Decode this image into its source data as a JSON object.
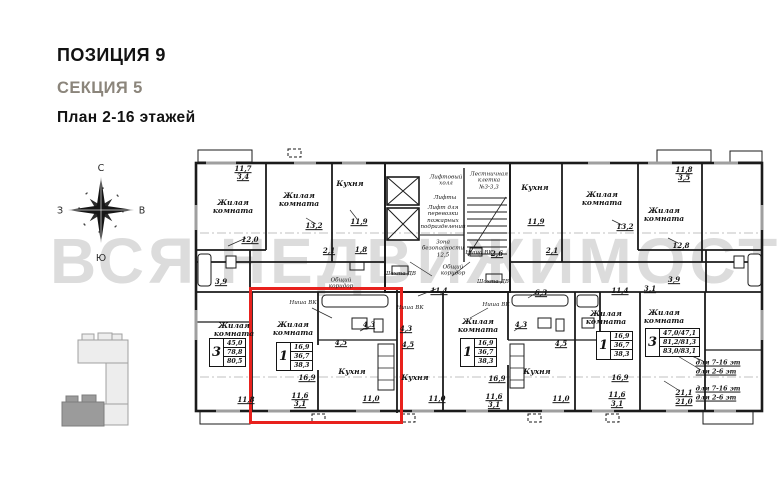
{
  "header": {
    "position": "ПОЗИЦИЯ 9",
    "section": "СЕКЦИЯ 5",
    "plan": "План 2-16 этажей"
  },
  "watermark": {
    "text": "ВСЯ НЕДВИЖИМОСТЬ"
  },
  "compass": {
    "north": "С",
    "south": "Ю",
    "west": "З",
    "east": "В"
  },
  "colors": {
    "accent_red": "#e8211d",
    "section_gray": "#8b857b",
    "watermark_gray": "#dcdcdc"
  },
  "plan": {
    "highlight": {
      "x": 249,
      "y": 287,
      "w": 148,
      "h": 131
    },
    "tables": [
      {
        "num": "3",
        "rows": [
          "45,0",
          "78,8",
          "80,5"
        ],
        "x": 209,
        "y": 338
      },
      {
        "num": "1",
        "rows": [
          "16,9",
          "36,7",
          "38,3"
        ],
        "x": 276,
        "y": 342
      },
      {
        "num": "1",
        "rows": [
          "16,9",
          "36,7",
          "38,3"
        ],
        "x": 460,
        "y": 338
      },
      {
        "num": "1",
        "rows": [
          "16,9",
          "36,7",
          "38,3"
        ],
        "x": 596,
        "y": 331
      },
      {
        "num": "3",
        "rows": [
          "47,0/47,1",
          "81,2/81,3",
          "83,0/83,1"
        ],
        "x": 645,
        "y": 328
      }
    ],
    "labels": [
      {
        "text": "11,7",
        "x": 243,
        "y": 169,
        "cls": "num"
      },
      {
        "text": "3,4",
        "x": 243,
        "y": 177,
        "cls": "num"
      },
      {
        "text": "Жилая\nкомната",
        "x": 233,
        "y": 207,
        "cls": "room"
      },
      {
        "text": "12,0",
        "x": 250,
        "y": 240,
        "cls": "num"
      },
      {
        "text": "Жилая\nкомната",
        "x": 299,
        "y": 200,
        "cls": "room"
      },
      {
        "text": "13,2",
        "x": 314,
        "y": 226,
        "cls": "num"
      },
      {
        "text": "Кухня",
        "x": 350,
        "y": 184,
        "cls": "room"
      },
      {
        "text": "11,9",
        "x": 359,
        "y": 222,
        "cls": "num"
      },
      {
        "text": "Лифтовый\nхолл",
        "x": 446,
        "y": 181,
        "cls": "tiny"
      },
      {
        "text": "Лифты",
        "x": 445,
        "y": 198,
        "cls": "tiny"
      },
      {
        "text": "Лифт для\nперевозки\nпожарных\nподразделений",
        "x": 443,
        "y": 218,
        "cls": "tiny"
      },
      {
        "text": "Лестничная\nклетка\n№3-3,3",
        "x": 489,
        "y": 181,
        "cls": "tiny"
      },
      {
        "text": "Зона\nбезопасности\n12,5",
        "x": 443,
        "y": 249,
        "cls": "tiny"
      },
      {
        "text": "Кухня",
        "x": 535,
        "y": 188,
        "cls": "room"
      },
      {
        "text": "11,9",
        "x": 536,
        "y": 222,
        "cls": "num"
      },
      {
        "text": "Жилая\nкомната",
        "x": 602,
        "y": 199,
        "cls": "room"
      },
      {
        "text": "13,2",
        "x": 625,
        "y": 227,
        "cls": "num"
      },
      {
        "text": "Жилая\nкомната",
        "x": 664,
        "y": 215,
        "cls": "room"
      },
      {
        "text": "12,8",
        "x": 681,
        "y": 246,
        "cls": "num"
      },
      {
        "text": "11,8",
        "x": 684,
        "y": 170,
        "cls": "num"
      },
      {
        "text": "3,5",
        "x": 684,
        "y": 178,
        "cls": "num"
      },
      {
        "text": "2,1",
        "x": 329,
        "y": 251,
        "cls": "num"
      },
      {
        "text": "1,8",
        "x": 361,
        "y": 250,
        "cls": "num"
      },
      {
        "text": "2,6",
        "x": 497,
        "y": 254,
        "cls": "num"
      },
      {
        "text": "2,1",
        "x": 552,
        "y": 251,
        "cls": "num"
      },
      {
        "text": "3,9",
        "x": 221,
        "y": 282,
        "cls": "num"
      },
      {
        "text": "3,9",
        "x": 674,
        "y": 280,
        "cls": "num"
      },
      {
        "text": "Шахта ДВ",
        "x": 400,
        "y": 274,
        "cls": "tiny"
      },
      {
        "text": "Шахта ДВ",
        "x": 493,
        "y": 282,
        "cls": "tiny"
      },
      {
        "text": "Общий\nкоридор",
        "x": 453,
        "y": 271,
        "cls": "tiny"
      },
      {
        "text": "Общий\nкоридор",
        "x": 341,
        "y": 284,
        "cls": "tiny"
      },
      {
        "text": "Ниша ВК",
        "x": 479,
        "y": 253,
        "cls": "tiny"
      },
      {
        "text": "Жилая\nкомната",
        "x": 234,
        "y": 330,
        "cls": "room"
      },
      {
        "text": "11,8",
        "x": 246,
        "y": 400,
        "cls": "num"
      },
      {
        "text": "Ниша ВК",
        "x": 303,
        "y": 303,
        "cls": "tiny"
      },
      {
        "text": "Жилая\nкомната",
        "x": 293,
        "y": 329,
        "cls": "room"
      },
      {
        "text": "16,9",
        "x": 307,
        "y": 378,
        "cls": "num"
      },
      {
        "text": "4,5",
        "x": 341,
        "y": 343,
        "cls": "num"
      },
      {
        "text": "4,3",
        "x": 369,
        "y": 325,
        "cls": "num"
      },
      {
        "text": "Кухня",
        "x": 352,
        "y": 372,
        "cls": "room"
      },
      {
        "text": "11,6",
        "x": 300,
        "y": 396,
        "cls": "num"
      },
      {
        "text": "3,1",
        "x": 300,
        "y": 404,
        "cls": "num"
      },
      {
        "text": "11,0",
        "x": 371,
        "y": 399,
        "cls": "num"
      },
      {
        "text": "11,4",
        "x": 439,
        "y": 291,
        "cls": "num"
      },
      {
        "text": "Ниша ВК",
        "x": 410,
        "y": 308,
        "cls": "tiny"
      },
      {
        "text": "4,3",
        "x": 406,
        "y": 329,
        "cls": "num"
      },
      {
        "text": "4,5",
        "x": 408,
        "y": 345,
        "cls": "num"
      },
      {
        "text": "Кухня",
        "x": 415,
        "y": 378,
        "cls": "room"
      },
      {
        "text": "11,0",
        "x": 437,
        "y": 399,
        "cls": "num"
      },
      {
        "text": "Ниша ВК",
        "x": 496,
        "y": 305,
        "cls": "tiny"
      },
      {
        "text": "Жилая\nкомната",
        "x": 478,
        "y": 326,
        "cls": "room"
      },
      {
        "text": "4,3",
        "x": 521,
        "y": 325,
        "cls": "num"
      },
      {
        "text": "4,5",
        "x": 561,
        "y": 344,
        "cls": "num"
      },
      {
        "text": "16,9",
        "x": 497,
        "y": 379,
        "cls": "num"
      },
      {
        "text": "Кухня",
        "x": 537,
        "y": 372,
        "cls": "room"
      },
      {
        "text": "11,6",
        "x": 494,
        "y": 397,
        "cls": "num"
      },
      {
        "text": "3,1",
        "x": 494,
        "y": 405,
        "cls": "num"
      },
      {
        "text": "11,0",
        "x": 561,
        "y": 399,
        "cls": "num"
      },
      {
        "text": "6,3",
        "x": 541,
        "y": 293,
        "cls": "num"
      },
      {
        "text": "Жилая\nкомната",
        "x": 606,
        "y": 318,
        "cls": "room"
      },
      {
        "text": "16,9",
        "x": 620,
        "y": 378,
        "cls": "num"
      },
      {
        "text": "11,6",
        "x": 617,
        "y": 395,
        "cls": "num"
      },
      {
        "text": "3,1",
        "x": 617,
        "y": 404,
        "cls": "num"
      },
      {
        "text": "11,4",
        "x": 620,
        "y": 291,
        "cls": "num"
      },
      {
        "text": "3,1",
        "x": 650,
        "y": 289,
        "cls": "num"
      },
      {
        "text": "Жилая\nкомната",
        "x": 664,
        "y": 317,
        "cls": "room"
      },
      {
        "text": "для 7-16 эт",
        "x": 718,
        "y": 364,
        "cls": "fl"
      },
      {
        "text": "для 2-6 эт",
        "x": 716,
        "y": 373,
        "cls": "fl"
      },
      {
        "text": "21,1",
        "x": 684,
        "y": 393,
        "cls": "num"
      },
      {
        "text": "для 7-16 эт",
        "x": 718,
        "y": 390,
        "cls": "fl"
      },
      {
        "text": "21,0",
        "x": 684,
        "y": 402,
        "cls": "num"
      },
      {
        "text": "для 2-6 эт",
        "x": 716,
        "y": 399,
        "cls": "fl"
      }
    ]
  }
}
